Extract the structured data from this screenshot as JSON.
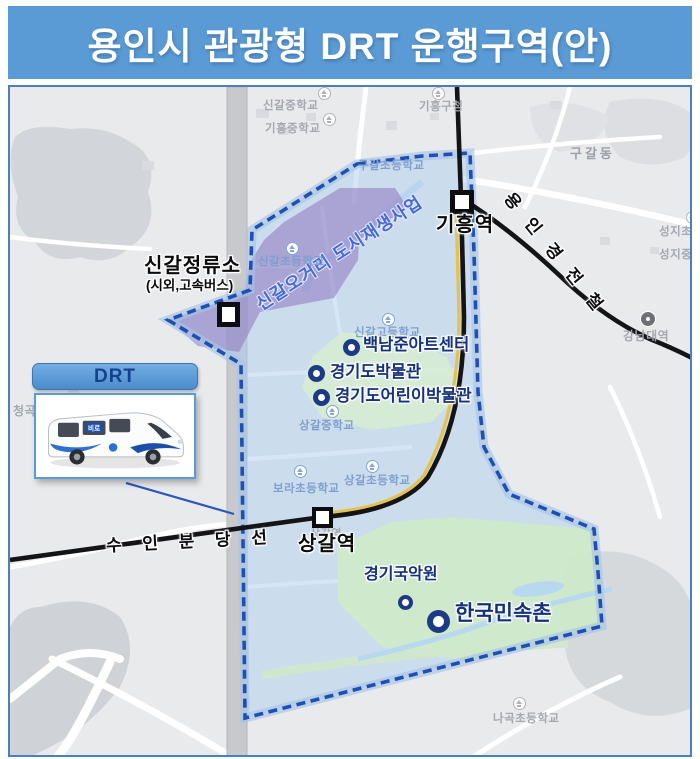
{
  "title": "용인시 관광형 DRT 운행구역(안)",
  "inset": {
    "label": "DRT",
    "bus_marking": "비로"
  },
  "zone": {
    "redevelopment_label": "신갈오거리 도시재생사업"
  },
  "rails": {
    "everline": "용 인 경 전 철",
    "suin_bundang": "수 인 분 당 선"
  },
  "stations": {
    "giheung": {
      "name": "기흥역"
    },
    "sanggal": {
      "name": "상갈역",
      "minor_label": "상갈역"
    },
    "singal_terminal": {
      "name": "신갈정류소",
      "sub": "(시외,고속버스)"
    }
  },
  "pois": [
    {
      "name": "백남준아트센터"
    },
    {
      "name": "경기도박물관"
    },
    {
      "name": "경기도어린이박물관"
    },
    {
      "name": "경기국악원"
    },
    {
      "name": "한국민속촌"
    }
  ],
  "map_labels": [
    {
      "name": "신갈중학교"
    },
    {
      "name": "기흥중학교"
    },
    {
      "name": "기흥구청"
    },
    {
      "name": "구갈동"
    },
    {
      "name": "구갈초등학교"
    },
    {
      "name": "신갈초등학교"
    },
    {
      "name": "신갈고등학교"
    },
    {
      "name": "상갈중학교"
    },
    {
      "name": "보라초등학교"
    },
    {
      "name": "상갈초등학교"
    },
    {
      "name": "성지초등학교"
    },
    {
      "name": "성지중학교"
    },
    {
      "name": "강남대역"
    },
    {
      "name": "나곡초등학교"
    },
    {
      "name": "청곡"
    }
  ],
  "colors": {
    "title_bar": "#5b9bd5",
    "boundary": "#1f4fb2",
    "redevelopment_fill": "#8b72bd",
    "poi": "#1d3a85",
    "rail": "#141416",
    "zone_fill": "#adcdee"
  }
}
